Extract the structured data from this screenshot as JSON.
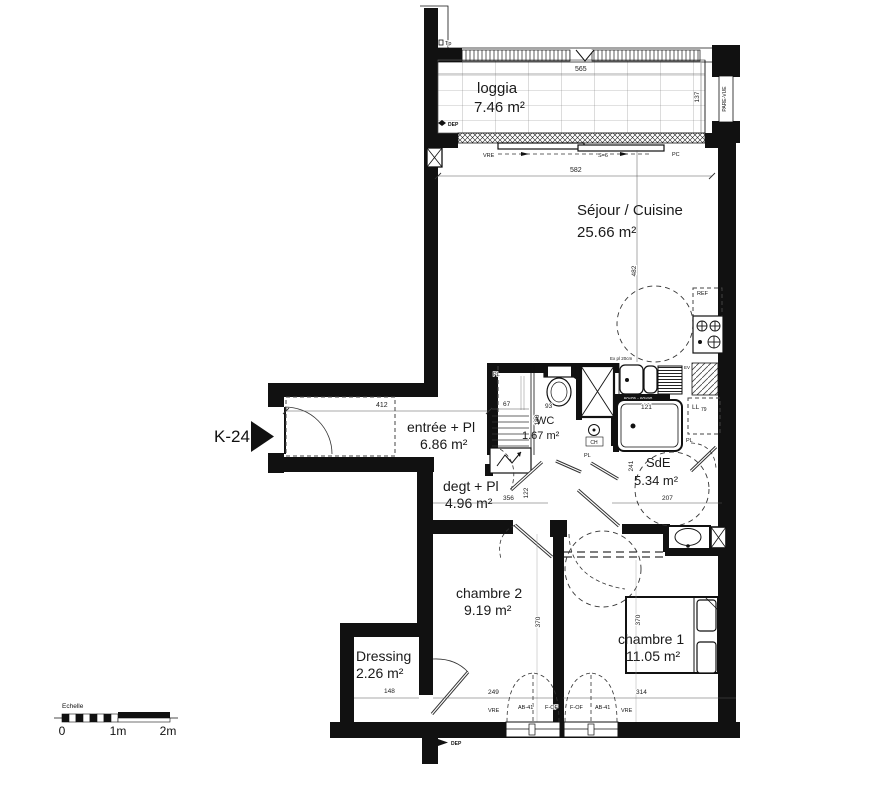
{
  "unit": {
    "label": "K-24"
  },
  "rooms": [
    {
      "name": "loggia",
      "area": "7.46 m²"
    },
    {
      "name": "Séjour / Cuisine",
      "area": "25.66 m²"
    },
    {
      "name": "entrée + Pl",
      "area": "6.86 m²"
    },
    {
      "name": "WC",
      "area": "1.67 m²"
    },
    {
      "name": "SdE",
      "area": "5.34 m²"
    },
    {
      "name": "degt + Pl",
      "area": "4.96 m²"
    },
    {
      "name": "chambre 2",
      "area": "9.19 m²"
    },
    {
      "name": "chambre 1",
      "area": "11.05 m²"
    },
    {
      "name": "Dressing",
      "area": "2.26 m²"
    }
  ],
  "dims": {
    "loggia_width": "565",
    "loggia_depth": "137",
    "sejour_width": "582",
    "sejour_height": "482",
    "entree_width": "412",
    "pl_width": "67",
    "pl_height": "180",
    "wc_width": "93",
    "shower_width": "121",
    "sde_height": "241",
    "sde_width": "207",
    "degt_width": "356",
    "degt_height": "122",
    "ch2_height": "370",
    "ch1_height": "370",
    "ch2_width": "249",
    "ch1_width": "314",
    "dressing_width": "148",
    "washer_size": "79"
  },
  "annotations": {
    "tp": "Tp",
    "dep": "DEP",
    "vre": "VRE",
    "s6": "S=6",
    "pc": "PC",
    "pare_vue": "PARE-VUE",
    "ref": "REF",
    "ev": "EV",
    "ch": "CH",
    "pl": "PL",
    "ll": "LL",
    "exhaust": "Ex pl 20cm",
    "counter_note": "60x05 - 60x90",
    "win_left": [
      "VRE",
      "AB-41",
      "F-OF"
    ],
    "win_right": [
      "F-OF",
      "AB-41",
      "VRE"
    ]
  },
  "scale_bar": {
    "label": "Echelle",
    "tick0": "0",
    "tick1": "1m",
    "tick2": "2m"
  },
  "colors": {
    "ink": "#111111",
    "wall": "#111111",
    "bg": "#ffffff"
  }
}
